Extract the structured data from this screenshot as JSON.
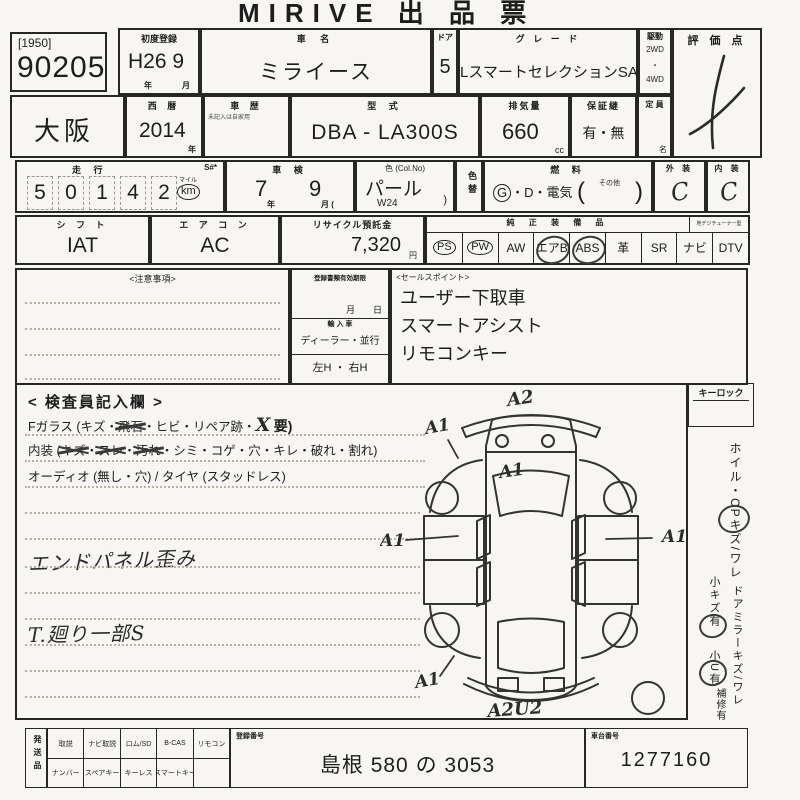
{
  "form": {
    "title": "MIRIVE 出 品 票",
    "sep": "・",
    "lot": {
      "bracket": "[1950]",
      "number": "90205"
    },
    "first_registration": {
      "label": "初度登録",
      "value": "H26 9",
      "unit_year": "年",
      "unit_month": "月"
    },
    "car_name": {
      "label": "車  名",
      "value": "ミライース"
    },
    "door": {
      "label": "ドア",
      "value": "5"
    },
    "grade": {
      "label": "グ レ ー ド",
      "value": "LスマートセレクションSA"
    },
    "drive": {
      "label": "駆動",
      "opt1": "2WD",
      "opt2": "4WD"
    },
    "score": {
      "label": "評 価 点"
    },
    "region": {
      "value": "大阪"
    },
    "year": {
      "label": "西  暦",
      "value": "2014",
      "unit": "年"
    },
    "history": {
      "label": "車  歴",
      "note": "未記入は自家用"
    },
    "model": {
      "label": "型  式",
      "value": "DBA - LA300S"
    },
    "displacement": {
      "label": "排気量",
      "value": "660",
      "unit": "cc"
    },
    "warranty": {
      "label": "保証継",
      "value": "有・無"
    },
    "capacity": {
      "label": "定 員",
      "unit": "名"
    },
    "mileage": {
      "label": "走  行",
      "s_mark": "S#*",
      "digits": [
        "5",
        "0",
        "1",
        "4",
        "2"
      ],
      "mile_label": "マイル",
      "km_label": "km"
    },
    "inspection_expiry": {
      "label": "車  検",
      "year": "7",
      "month": "9",
      "unit_year": "年",
      "unit_month": "月 ("
    },
    "color": {
      "label": "色 (Col.No)",
      "value": "パール",
      "code": "W24",
      "paren": ")"
    },
    "color_change": {
      "label": "色替"
    },
    "fuel": {
      "label": "燃  料",
      "g": "G",
      "rest": "・D・電気",
      "paren_open": "(",
      "other": "その他",
      "paren_close": ")"
    },
    "exterior": {
      "label": "外 装",
      "value": "C"
    },
    "interior": {
      "label": "内 装",
      "value": "C"
    },
    "shift": {
      "label": "シ フ ト",
      "value": "IAT"
    },
    "aircon": {
      "label": "エ ア コ ン",
      "value": "AC"
    },
    "recycle": {
      "label": "リサイクル預託金",
      "value": "7,320",
      "unit": "円"
    },
    "equipment": {
      "label": "純 正 装 備 品",
      "tuner_label": "地デジチューナー型",
      "items": [
        "PS",
        "PW",
        "AW",
        "エアB",
        "ABS",
        "革",
        "SR",
        "ナビ",
        "DTV"
      ]
    },
    "caution": {
      "label": "<注意事項>"
    },
    "documents": {
      "expiry_label": "登録書類有効期限",
      "expiry_units": "月　　日",
      "import_label": "輸 入 車",
      "import_options": "ディーラー・並行",
      "handle_options": "左H ・ 右H"
    },
    "sales": {
      "label": "<セールスポイント>",
      "points": [
        "ユーザー下取車",
        "スマートアシスト",
        "リモコンキー"
      ]
    },
    "inspector": {
      "title": "< 検査員記入欄 >",
      "fglass_prefix": "Fガラス (キズ・",
      "fglass_struck": "飛石",
      "fglass_mid": "・ヒビ・リペア跡・",
      "fglass_x": "X",
      "fglass_suffix": "要)",
      "interior_prefix": "内装 (",
      "interior_struck1": "キズ",
      "interior_struck2": "スレ",
      "interior_struck3": "汚れ",
      "interior_suffix": "・シミ・コゲ・穴・キレ・破れ・割れ)",
      "audio_line": "オーディオ (無し・穴) / タイヤ (スタッドレス)",
      "note1": "エンドパネル歪み",
      "note2": "T.廻り一部S",
      "annotations": {
        "top": "A2",
        "top_left": "A1",
        "hood": "A1",
        "left": "A1",
        "right": "A1",
        "bottom_left": "A1",
        "bottom": "A2U2"
      }
    },
    "right_col": {
      "keylock": "キーロック",
      "wheel": "ホイル・CPキズ/ワレ",
      "wheel_small": "小キズ有",
      "mirror": "ドアミラーキズ/ワレ",
      "mirror_small": "小U有",
      "repair": "補修有"
    },
    "dispatch": {
      "label": "発送品",
      "row_top": [
        "取説",
        "ナビ取説",
        "ロム/SD",
        "B-CAS",
        "リモコン"
      ],
      "row_bottom": [
        "ナンバー",
        "スペアキー",
        "キーレス",
        "スマートキー"
      ],
      "registration": {
        "label": "登録番号",
        "value": "島根 580 の 3053"
      },
      "chassis": {
        "label": "車台番号",
        "value": "1277160"
      }
    }
  }
}
